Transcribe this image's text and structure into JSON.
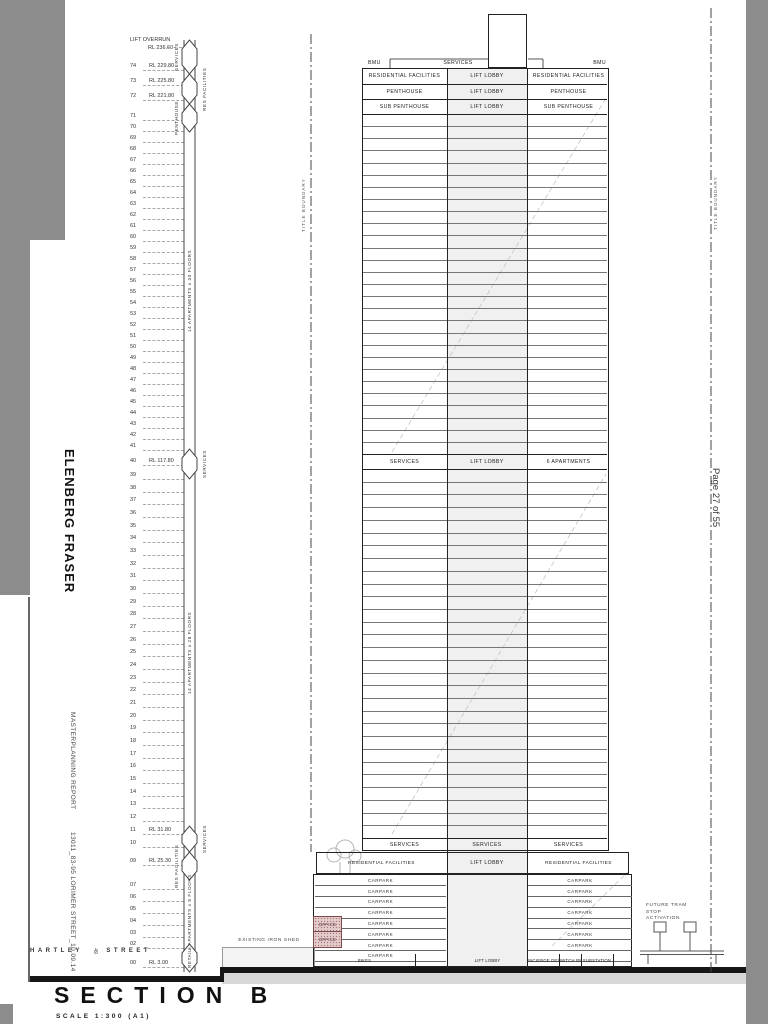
{
  "page": {
    "indicator": "Page 27 of 55"
  },
  "branding": {
    "firm": "ELENBERG FRASER",
    "report": "MASTERPLANNING REPORT",
    "project": "13011_83-95 LORIMER STREET_10.09.14"
  },
  "titleblock": {
    "title": "SECTION B",
    "scale": "SCALE 1:300 (A1)"
  },
  "site": {
    "boundary": "TITLE BOUNDARY",
    "shed": "EXISTING IRON SHED",
    "tram": "FUTURE TRAM STOP ACTIVATION",
    "street_left": "HARTLEY",
    "street_no": "49",
    "street_right": "STREET"
  },
  "levels": {
    "top_label": "LIFT OVERRUN",
    "top_rl": "RL 236.60",
    "entries": [
      {
        "no": "74",
        "rl": "RL 229.80"
      },
      {
        "no": "73",
        "rl": "RL 225.80"
      },
      {
        "no": "72",
        "rl": "RL 221.80"
      },
      {
        "no": "71"
      },
      {
        "no": "70"
      },
      {
        "no": "69"
      },
      {
        "no": "68"
      },
      {
        "no": "67"
      },
      {
        "no": "66"
      },
      {
        "no": "65"
      },
      {
        "no": "64"
      },
      {
        "no": "63"
      },
      {
        "no": "62"
      },
      {
        "no": "61"
      },
      {
        "no": "60"
      },
      {
        "no": "59"
      },
      {
        "no": "58"
      },
      {
        "no": "57"
      },
      {
        "no": "56"
      },
      {
        "no": "55"
      },
      {
        "no": "54"
      },
      {
        "no": "53"
      },
      {
        "no": "52"
      },
      {
        "no": "51"
      },
      {
        "no": "50"
      },
      {
        "no": "49"
      },
      {
        "no": "48"
      },
      {
        "no": "47"
      },
      {
        "no": "46"
      },
      {
        "no": "45"
      },
      {
        "no": "44"
      },
      {
        "no": "43"
      },
      {
        "no": "42"
      },
      {
        "no": "41"
      },
      {
        "no": "40",
        "rl": "RL 117.80"
      },
      {
        "no": "39"
      },
      {
        "no": "38"
      },
      {
        "no": "37"
      },
      {
        "no": "36"
      },
      {
        "no": "35"
      },
      {
        "no": "34"
      },
      {
        "no": "33"
      },
      {
        "no": "32"
      },
      {
        "no": "31"
      },
      {
        "no": "30"
      },
      {
        "no": "29"
      },
      {
        "no": "28"
      },
      {
        "no": "27"
      },
      {
        "no": "26"
      },
      {
        "no": "25"
      },
      {
        "no": "24"
      },
      {
        "no": "23"
      },
      {
        "no": "22"
      },
      {
        "no": "21"
      },
      {
        "no": "20"
      },
      {
        "no": "19"
      },
      {
        "no": "18"
      },
      {
        "no": "17"
      },
      {
        "no": "16"
      },
      {
        "no": "15"
      },
      {
        "no": "14"
      },
      {
        "no": "13"
      },
      {
        "no": "12"
      },
      {
        "no": "11",
        "rl": "RL 31.80"
      },
      {
        "no": "10"
      },
      {
        "no": "09",
        "rl": "RL 25.30"
      },
      {
        "no": "07"
      },
      {
        "no": "06"
      },
      {
        "no": "05"
      },
      {
        "no": "04"
      },
      {
        "no": "03"
      },
      {
        "no": "02"
      },
      {
        "no": "00",
        "rl": "RL 3.00"
      }
    ]
  },
  "strip": {
    "segments": [
      {
        "type": "diamond",
        "label": "SERVICES"
      },
      {
        "type": "diamond",
        "label": "RES FACILITIES"
      },
      {
        "type": "diamond",
        "label": "PENTHOUSE"
      },
      {
        "type": "bar",
        "label": "14 APARTMENTS x 30 FLOORS"
      },
      {
        "type": "diamond",
        "label": "SERVICES"
      },
      {
        "type": "bar",
        "label": "14 APARTMENTS x 28 FLOORS"
      },
      {
        "type": "diamond",
        "label": "SERVICES"
      },
      {
        "type": "diamond",
        "label": "RES FACILITIES"
      },
      {
        "type": "bar",
        "label": "6 APARTMENTS x 8 FLOORS"
      },
      {
        "type": "diamond",
        "label": "RETAIL"
      }
    ]
  },
  "tower": {
    "roof": {
      "left": "BMU",
      "center": "SERVICES",
      "right": "BMU"
    },
    "bands_top": [
      {
        "l": "RESIDENTIAL FACILITIES",
        "c": "LIFT LOBBY",
        "r": "RESIDENTIAL FACILITIES"
      },
      {
        "l": "PENTHOUSE",
        "c": "LIFT LOBBY",
        "r": "PENTHOUSE"
      },
      {
        "l": "SUB PENTHOUSE",
        "c": "LIFT LOBBY",
        "r": "SUB PENTHOUSE"
      }
    ],
    "band_mid": {
      "l": "SERVICES",
      "c": "LIFT LOBBY",
      "r": "6 APARTMENTS"
    },
    "band_services": {
      "l": "SERVICES",
      "c": "SERVICES",
      "r": "SERVICES"
    },
    "podium_band": {
      "l": "RESIDENTIAL FACILITIES",
      "c": "LIFT LOBBY",
      "r": "RESIDENTIAL FACILITIES"
    },
    "carpark_label": "CARPARK",
    "office_label": "OFFICE",
    "bottom": {
      "bikes": "BIKES",
      "lift": "LIFT LOBBY",
      "concierge": "CONCIERGE DESK",
      "switch": "SWITCH RM",
      "substation": "SUBSTATION"
    }
  },
  "colors": {
    "viewer_gray": "#8c8c8c",
    "office_pink": "#e3cbcb",
    "earth": "#d8d8d8",
    "core_gray": "#f0f0f0"
  }
}
